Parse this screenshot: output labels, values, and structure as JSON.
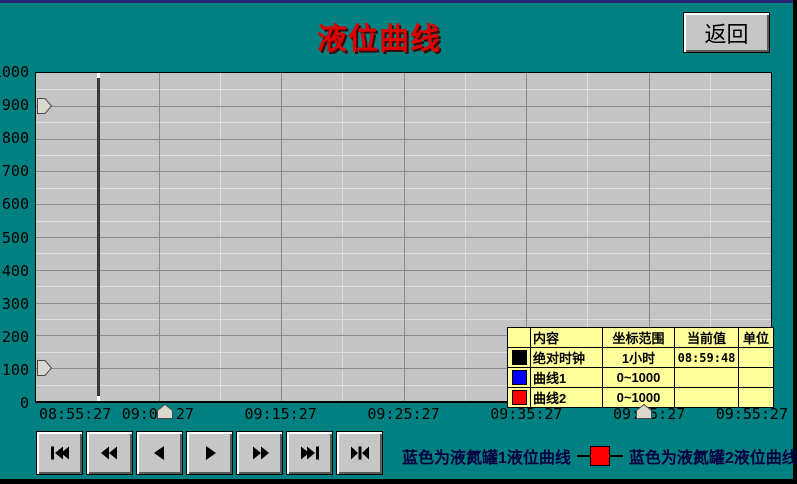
{
  "window": {
    "title": "液位曲线",
    "bg_color": "#008080",
    "title_color": "#e00000"
  },
  "back_button": {
    "label": "返回"
  },
  "chart_data": {
    "type": "line",
    "title": "液位曲线",
    "xlabel": "",
    "ylabel": "",
    "ylim": [
      0,
      1000
    ],
    "y_ticks": [
      0,
      100,
      200,
      300,
      400,
      500,
      600,
      700,
      800,
      900,
      1000
    ],
    "x_ticks": [
      "08:55:27",
      "09:05:27",
      "09:15:27",
      "09:25:27",
      "09:35:27",
      "09:45:27",
      "09:55:27"
    ],
    "x_span": "1小时",
    "grid": "on",
    "plot_bg": "#c4c4c4",
    "series": [
      {
        "name": "曲线1",
        "color": "#0000ff",
        "range": "0~1000",
        "values": []
      },
      {
        "name": "曲线2",
        "color": "#ff0000",
        "range": "0~1000",
        "values": []
      }
    ],
    "cursor": {
      "x_percent": 8.3,
      "current_time": "08:59:48"
    }
  },
  "sliders": {
    "y_left": [
      {
        "value": 900
      },
      {
        "value": 100
      }
    ],
    "x_bottom": [
      {
        "percent": 17.6
      },
      {
        "percent": 82.7
      }
    ]
  },
  "legend_table": {
    "bg": "#ffff9c",
    "headers": [
      "",
      "内容",
      "坐标范围",
      "当前值",
      "单位"
    ],
    "rows": [
      {
        "swatch": "#000000",
        "cells": [
          "绝对时钟",
          "1小时",
          "08:59:48",
          ""
        ]
      },
      {
        "swatch": "#0000ff",
        "cells": [
          "曲线1",
          "0~1000",
          "",
          ""
        ]
      },
      {
        "swatch": "#ff0000",
        "cells": [
          "曲线2",
          "0~1000",
          "",
          ""
        ]
      }
    ]
  },
  "controls": {
    "buttons": [
      {
        "icon": "skip-to-start"
      },
      {
        "icon": "rewind"
      },
      {
        "icon": "step-back"
      },
      {
        "icon": "step-forward"
      },
      {
        "icon": "fast-forward"
      },
      {
        "icon": "skip-to-end"
      },
      {
        "icon": "jump-to-cursor"
      }
    ]
  },
  "footer": {
    "legend1": "蓝色为液氮罐1液位曲线",
    "legend2": "蓝色为液氮罐2液位曲线",
    "marker_color": "#ff0000",
    "text_color": "#000040"
  }
}
